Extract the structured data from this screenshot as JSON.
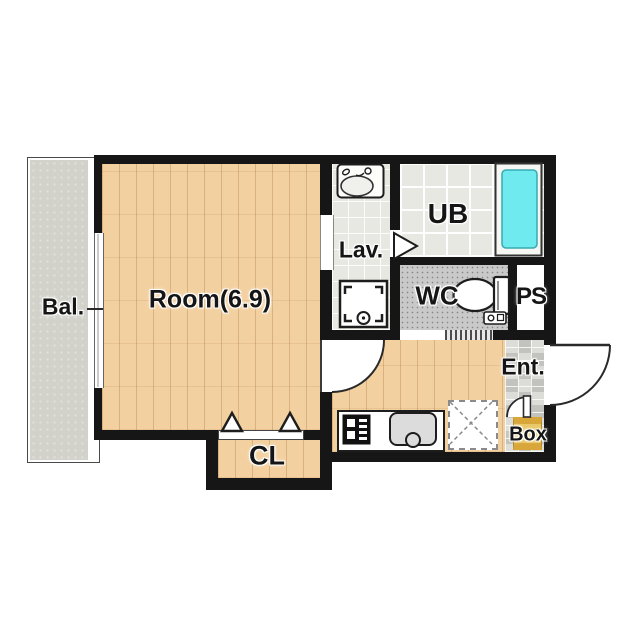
{
  "floorplan": {
    "type": "apartment-floor-plan",
    "rooms": {
      "balcony": {
        "label": "Bal."
      },
      "main_room": {
        "label": "Room(6.9)"
      },
      "lavatory": {
        "label": "Lav."
      },
      "unit_bath": {
        "label": "UB"
      },
      "toilet": {
        "label": "WC"
      },
      "pipe_space": {
        "label": "PS"
      },
      "entrance": {
        "label": "Ent."
      },
      "shoe_box": {
        "label": "Box"
      },
      "closet": {
        "label": "CL"
      }
    },
    "colors": {
      "wall": "#161616",
      "wood": "#f3d09f",
      "balcony": "#d2d2cb",
      "tile_light": "#e8e8e2",
      "wc_floor": "#c9c9c9",
      "ent_tile": "#d6d6d2",
      "tub": "#6feaee",
      "box_gold": "#eac767",
      "box_gold_dark": "#d9a63a"
    }
  }
}
